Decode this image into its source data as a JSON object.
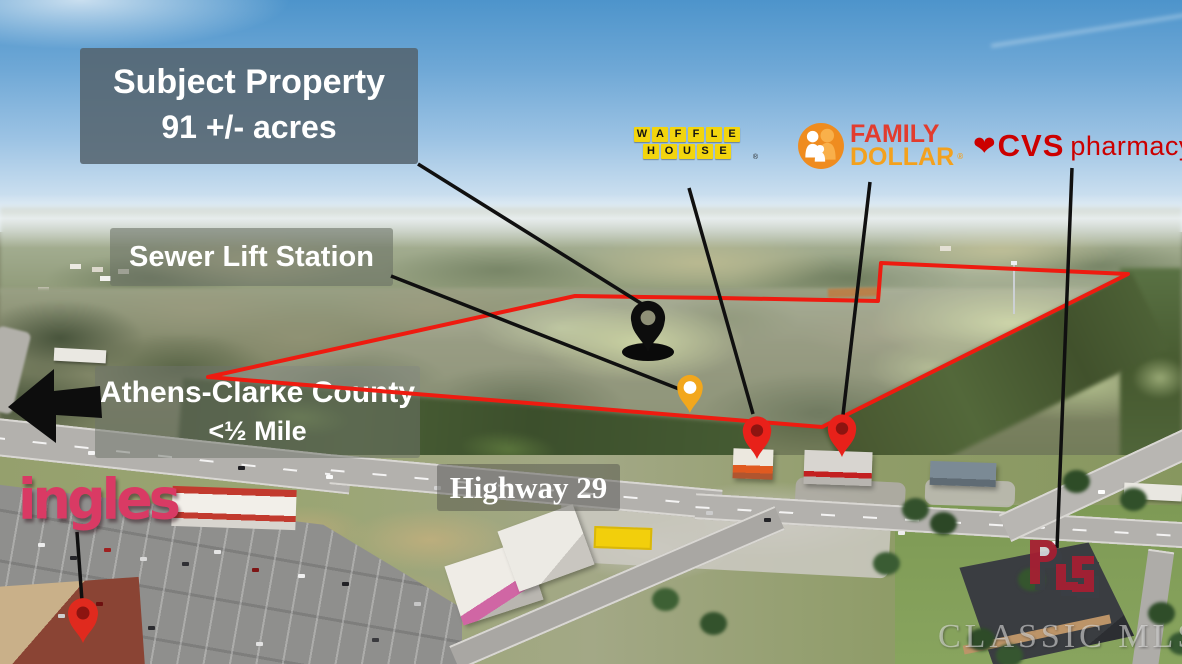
{
  "labels": {
    "subject_property": {
      "line1": "Subject Property",
      "line2": "91 +/- acres"
    },
    "sewer_lift_station": "Sewer Lift Station",
    "athens_clarke_county": {
      "line1": "Athens-Clarke County",
      "line2": "<½ Mile"
    },
    "highway": "Highway 29"
  },
  "logos": {
    "waffle_house": {
      "line1": "WAFFLE",
      "line2": "HOUSE",
      "registered": "®"
    },
    "family_dollar": {
      "word1": "FAMILY",
      "word2": "DOLLAR",
      "registered": "®"
    },
    "cvs": {
      "name": "CVS",
      "suffix": "pharmacy",
      "registered": "®",
      "heart": "❤"
    },
    "ingles": "ingles"
  },
  "watermark": {
    "text": "CLASSIC MLS"
  },
  "markers": {
    "subject_property_pin": {
      "color": "#0d0d0d"
    },
    "sewer_lift_station_pin": {
      "color": "#f2a71c"
    },
    "waffle_house_pin": {
      "color": "#e8211a"
    },
    "family_dollar_pin": {
      "color": "#e8211a"
    },
    "ingles_pin": {
      "color": "#e02a1e"
    }
  },
  "colors": {
    "boundary_red": "#ee1b10",
    "cvs_red": "#cc0000",
    "ingles_pink": "#d93a64",
    "waffle_house_yellow": "#f2d50e",
    "family_red": "#e23c2e",
    "dollar_orange": "#f3a11d",
    "family_dollar_circle": "#ef8c1f",
    "label_box_gray": "rgba(84,99,110,0.86)"
  }
}
